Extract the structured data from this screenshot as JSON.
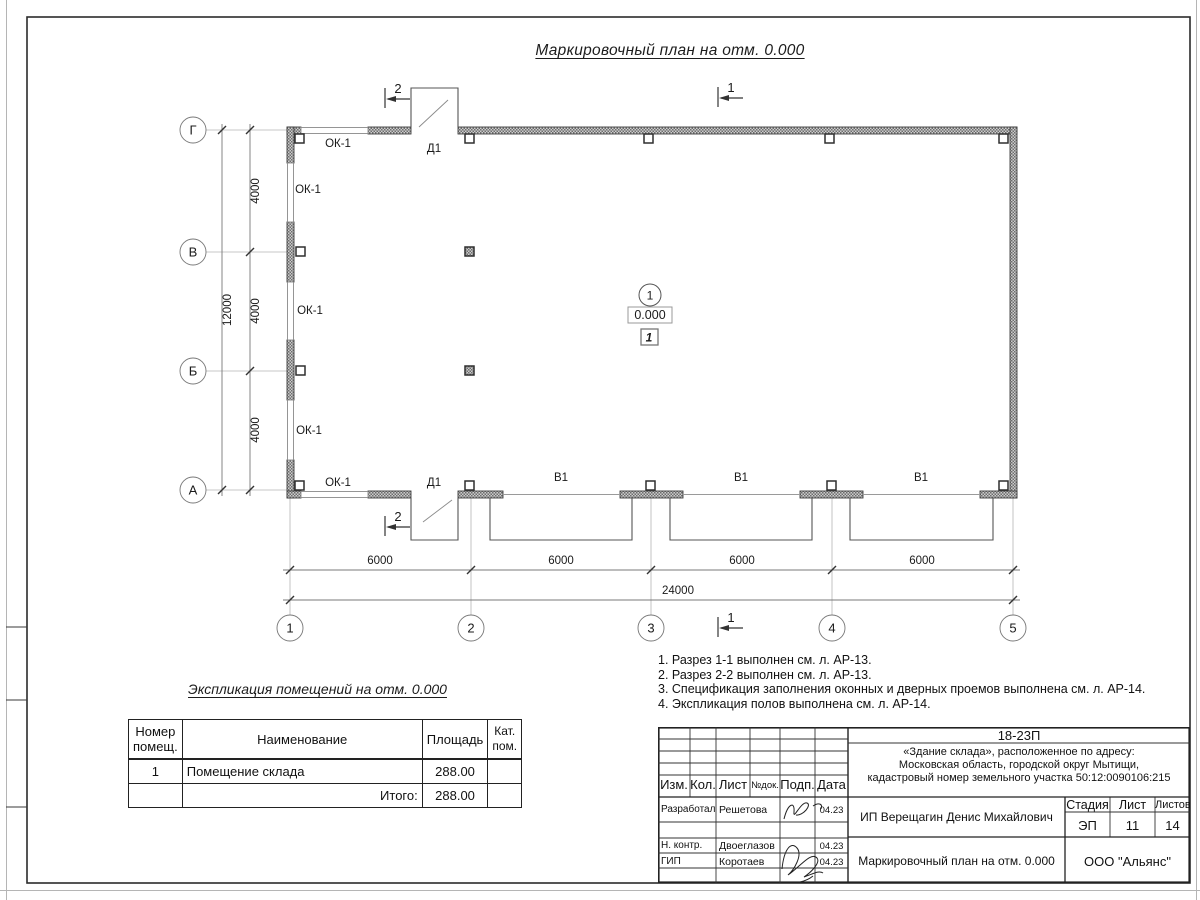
{
  "plan": {
    "title": "Маркировочный план на отм. 0.000",
    "grid": {
      "row_g": "Г",
      "row_v": "В",
      "row_b": "Б",
      "row_a": "А",
      "col_1": "1",
      "col_2": "2",
      "col_3": "3",
      "col_4": "4",
      "col_5": "5"
    },
    "dimensions": {
      "row_spacing": [
        "4000",
        "4000",
        "4000"
      ],
      "row_total": "12000",
      "col_spacing": [
        "6000",
        "6000",
        "6000",
        "6000"
      ],
      "col_total": "24000"
    },
    "marks": {
      "window": "ОК-1",
      "door": "Д1",
      "gate": "В1"
    },
    "room": {
      "number": "1",
      "elevation": "0.000",
      "floor_mark": "1"
    },
    "sections": {
      "s1": "1",
      "s2": "2"
    }
  },
  "notes": [
    "1. Разрез 1-1 выполнен см. л. АР-13.",
    "2. Разрез 2-2 выполнен см. л. АР-13.",
    "3. Спецификация заполнения оконных и дверных проемов выполнена см. л. АР-14.",
    "4. Экспликация полов выполнена см. л. АР-14."
  ],
  "explication": {
    "title": "Экспликация помещений на отм. 0.000",
    "headers": {
      "number": "Номер помещ.",
      "name": "Наименование",
      "area": "Площадь",
      "category": "Кат. пом."
    },
    "row": {
      "number": "1",
      "name": "Помещение склада",
      "area": "288.00"
    },
    "total": {
      "label": "Итого:",
      "area": "288.00"
    }
  },
  "title_block": {
    "doc_code": "18-23П",
    "project_description": "«Здание склада», расположенное по адресу:\nМосковская область, городской округ Мытищи,\nкадастровый номер земельного участка 50:12:0090106:215",
    "header": {
      "izm": "Изм.",
      "kol": "Кол.",
      "list": "Лист",
      "ndoc": "№док.",
      "podp": "Подп.",
      "data": "Дата"
    },
    "signers": [
      {
        "role": "Разработал",
        "name": "Решетова",
        "date": "04.23"
      },
      {
        "role": "Н. контр.",
        "name": "Двоеглазов",
        "date": "04.23"
      },
      {
        "role": "ГИП",
        "name": "Коротаев",
        "date": "04.23"
      }
    ],
    "client": "ИП Верещагин Денис Михайлович",
    "stage_label": "Стадия",
    "stage_value": "ЭП",
    "sheet_label": "Лист",
    "sheet_value": "11",
    "sheets_label": "Листов",
    "sheets_value": "14",
    "drawing_name": "Маркировочный план на отм. 0.000",
    "company": "ООО \"Альянс\""
  }
}
